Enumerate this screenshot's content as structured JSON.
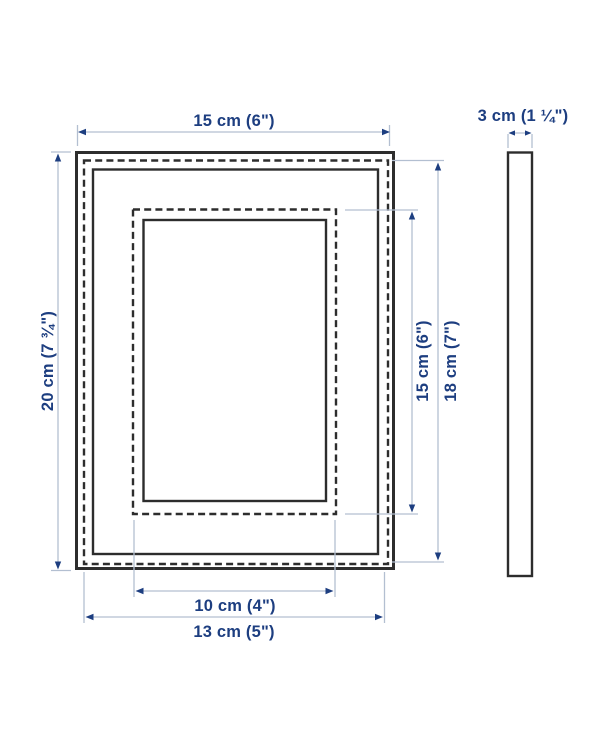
{
  "colors": {
    "label_text": "#1d3e80",
    "arrowhead": "#1d3e80",
    "dimension_line": "#b3bfd1",
    "frame_outline": "#2d2d2d",
    "background": "#ffffff"
  },
  "front_view": {
    "labels": {
      "outer_width": "15 cm (6\")",
      "outer_height": "20 cm (7 ¾\")",
      "opening_height": "15 cm (6\")",
      "picture_height": "18 cm (7\")",
      "opening_width": "10 cm (4\")",
      "picture_width": "13 cm (5\")"
    }
  },
  "side_view": {
    "labels": {
      "depth": "3 cm (1 ¼\")"
    }
  }
}
